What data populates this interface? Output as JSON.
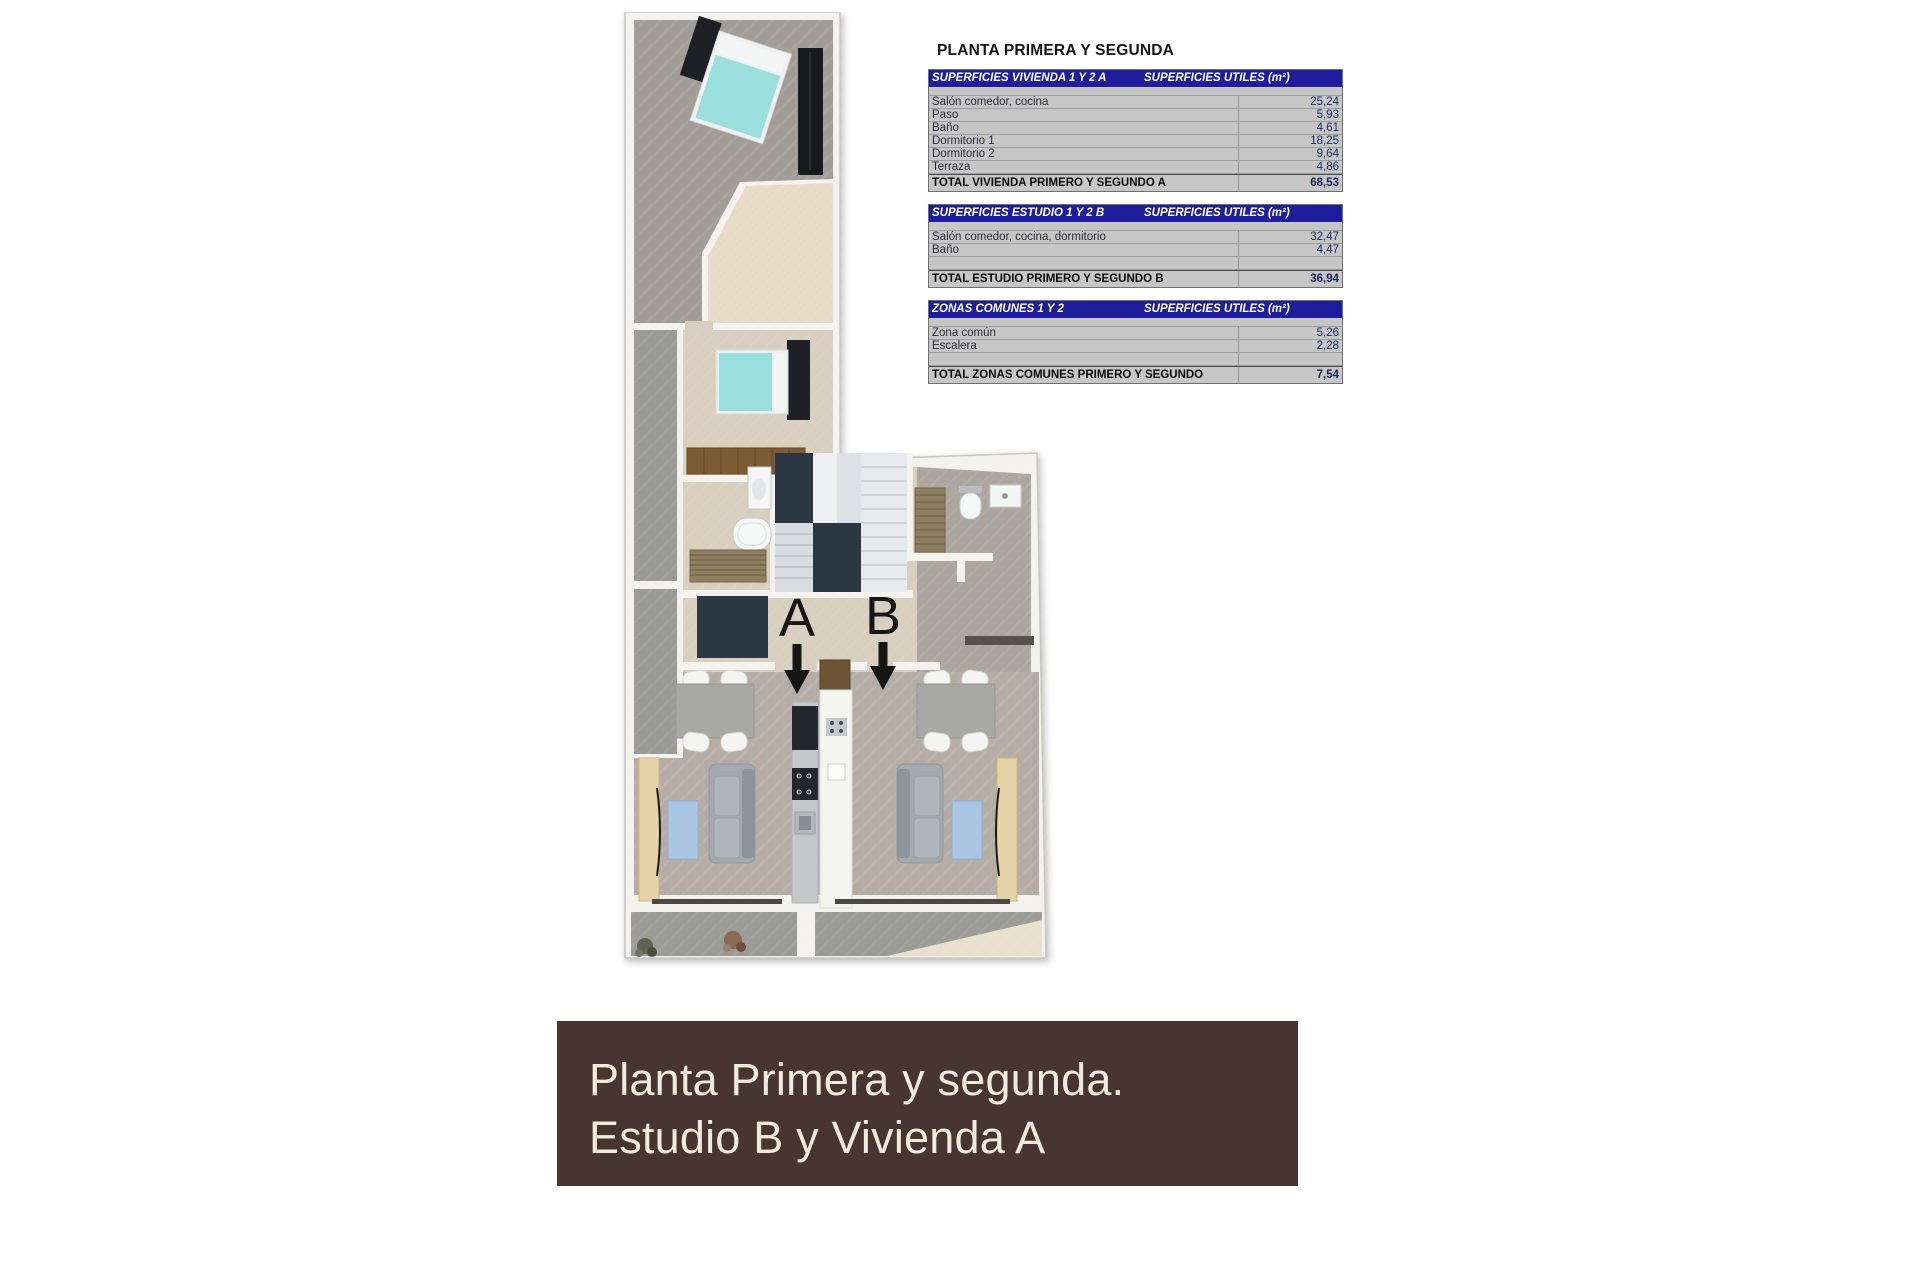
{
  "sheet": {
    "title": "PLANTA PRIMERA Y SEGUNDA",
    "tables": [
      {
        "header_left": "SUPERFICIES VIVIENDA 1 Y 2 A",
        "header_right": "SUPERFICIES UTILES  (m²)",
        "rows": [
          [
            "Salón comedor, cocina",
            "25,24"
          ],
          [
            "Paso",
            "5,93"
          ],
          [
            "Baño",
            "4,61"
          ],
          [
            "Dormitorio 1",
            "18,25"
          ],
          [
            "Dormitorio 2",
            "9,64"
          ],
          [
            "Terraza",
            "4,86"
          ]
        ],
        "total_label": "TOTAL VIVIENDA PRIMERO Y SEGUNDO A",
        "total_value": "68,53"
      },
      {
        "header_left": "SUPERFICIES ESTUDIO 1 Y 2 B",
        "header_right": "SUPERFICIES UTILES  (m²)",
        "rows": [
          [
            "Salón comedor, cocina, dormitorio",
            "32,47"
          ],
          [
            "Baño",
            "4,47"
          ],
          [
            "",
            ""
          ]
        ],
        "total_label": "TOTAL ESTUDIO PRIMERO Y SEGUNDO B",
        "total_value": "36,94"
      },
      {
        "header_left": "ZONAS COMUNES 1 Y 2",
        "header_right": "SUPERFICIES UTILES  (m²)",
        "rows": [
          [
            "Zona común",
            "5,26"
          ],
          [
            "Escalera",
            "2,28"
          ],
          [
            "",
            ""
          ]
        ],
        "total_label": "TOTAL ZONAS COMUNES PRIMERO Y SEGUNDO",
        "total_value": "7,54"
      }
    ]
  },
  "floorplan": {
    "unit_a_label": "A",
    "unit_b_label": "B"
  },
  "banner": {
    "line1": "Planta Primera y segunda.",
    "line2": "Estudio B y Vivienda A"
  },
  "colors": {
    "table_header_bg": "#1e1e9c",
    "table_row_bg": "#c6c6c6",
    "banner_bg": "#483530",
    "banner_text": "#f1ebdf",
    "value_text": "#1c2a66",
    "bed_accent": "#9adfde",
    "rug_accent": "#abc5e4"
  }
}
